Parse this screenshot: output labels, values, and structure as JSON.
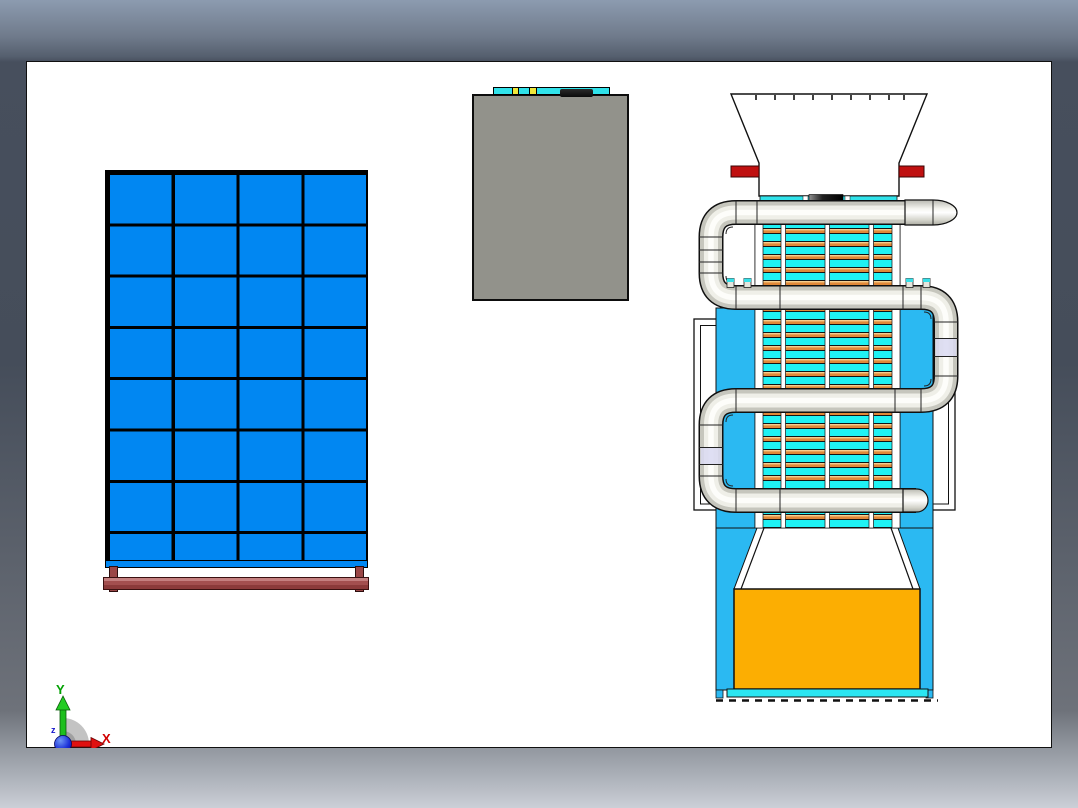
{
  "app": {
    "type": "cad-viewport",
    "description": "white drawing sheet on shaded viewport background"
  },
  "triad": {
    "x_label": "X",
    "y_label": "Y",
    "z_label": "z"
  },
  "palette": {
    "background_top": "#8C9BB0",
    "background_bottom": "#CBCFD7",
    "sheet": "#FFFFFF",
    "panel_blue": "#0187F2",
    "stand_brown": "#9A4646",
    "box_gray": "#92928B",
    "strip_cyan": "#30E2EA",
    "strip_yellow": "#EFE73A",
    "machine_blue": "#2BB9F2",
    "tube_cyan": "#1FF2F4",
    "tube_orange": "#E08838",
    "pipe_light": "#EFEFE8",
    "red_clamp": "#C01010",
    "bin_orange": "#FCAE02",
    "base_cyan": "#2BE6F2",
    "lavender": "#D9D9F1",
    "axis_x": "#D00000",
    "axis_y": "#00A000",
    "axis_z": "#1515CC"
  },
  "objects": {
    "blue_grid_panel": {
      "columns": 4,
      "rows": 8,
      "stand": "brown beam on two legs"
    },
    "gray_box": {
      "top_strip_segments": "cyan with two yellow inserts and one black bar"
    },
    "machine": {
      "hopper": "white trapezoid funnel with tick marks",
      "red_clamps": 2,
      "pipe_runs": 4,
      "pipe_end_caps": 2,
      "tube_sections": 4,
      "discharge_bin": "orange",
      "base_strip": "cyan over dashed ground line"
    }
  }
}
